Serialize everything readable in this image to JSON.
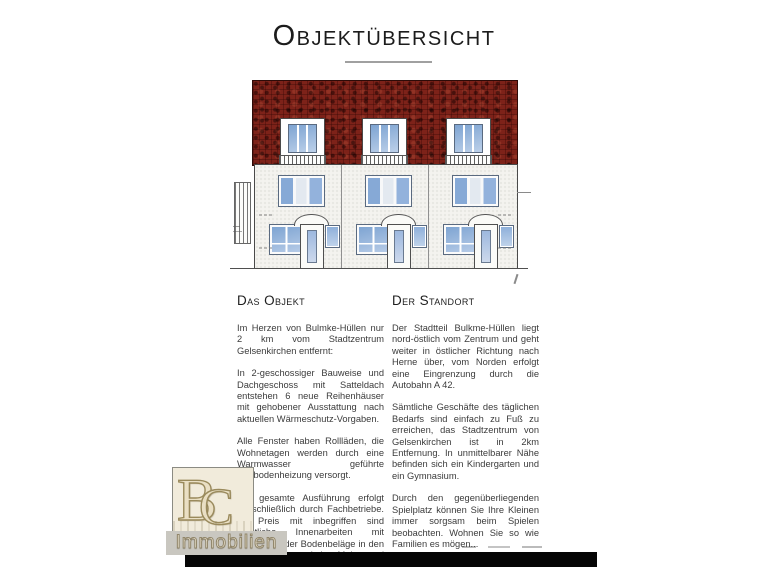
{
  "page": {
    "title": "Objektübersicht"
  },
  "sections": {
    "object": {
      "heading": "Das Objekt",
      "paragraphs": [
        "Im Herzen von Bulmke-Hüllen nur 2 km vom Stadtzentrum Gelsenkirchen entfernt:",
        "In 2-geschossiger Bauweise und Dachgeschoss mit Satteldach entstehen 6 neue Reihenhäuser mit gehobener Ausstattung nach aktuellen Wärmeschutz-Vorgaben.",
        "Alle Fenster haben Rollläden, die Wohnetagen werden durch eine Warmwasser geführte Fußbodenheizung versorgt.",
        "Die gesamte Ausführung erfolgt ausschließlich durch Fachbetriebe. Im Preis mit inbegriffen sind sämtliche Innenarbeiten mit Ausnahme der Bodenbeläge in den Wohnräumen und den Maler- und Lackierarbeiten."
      ]
    },
    "location": {
      "heading": "Der Standort",
      "paragraphs": [
        "Der Stadtteil Bulkme-Hüllen liegt nord-östlich vom Zentrum und geht weiter in östlicher Richtung nach Herne über, vom Norden erfolgt eine Eingrenzung durch die Autobahn A 42.",
        "Sämtliche Geschäfte des täglichen Bedarfs sind einfach zu Fuß zu erreichen, das Stadtzentrum von Gelsenkirchen ist in 2km Entfernung. In unmittelbarer Nähe befinden sich ein Kindergarten und ein Gymnasium.",
        "Durch den gegenüberliegenden Spielplatz können Sie Ihre Kleinen immer sorgsam beim Spielen beobachten. Wohnen Sie so wie Familien es mögen..."
      ]
    }
  },
  "drawing": {
    "subject": "building-front-elevation",
    "house_units": 3,
    "colors": {
      "roof_red": "#7d2219",
      "window_blue": "#8fb0da",
      "facade": "#f4f3ef"
    }
  },
  "watermark": {
    "monogram_b": "B",
    "monogram_c": "C",
    "label": "Immobilien"
  }
}
